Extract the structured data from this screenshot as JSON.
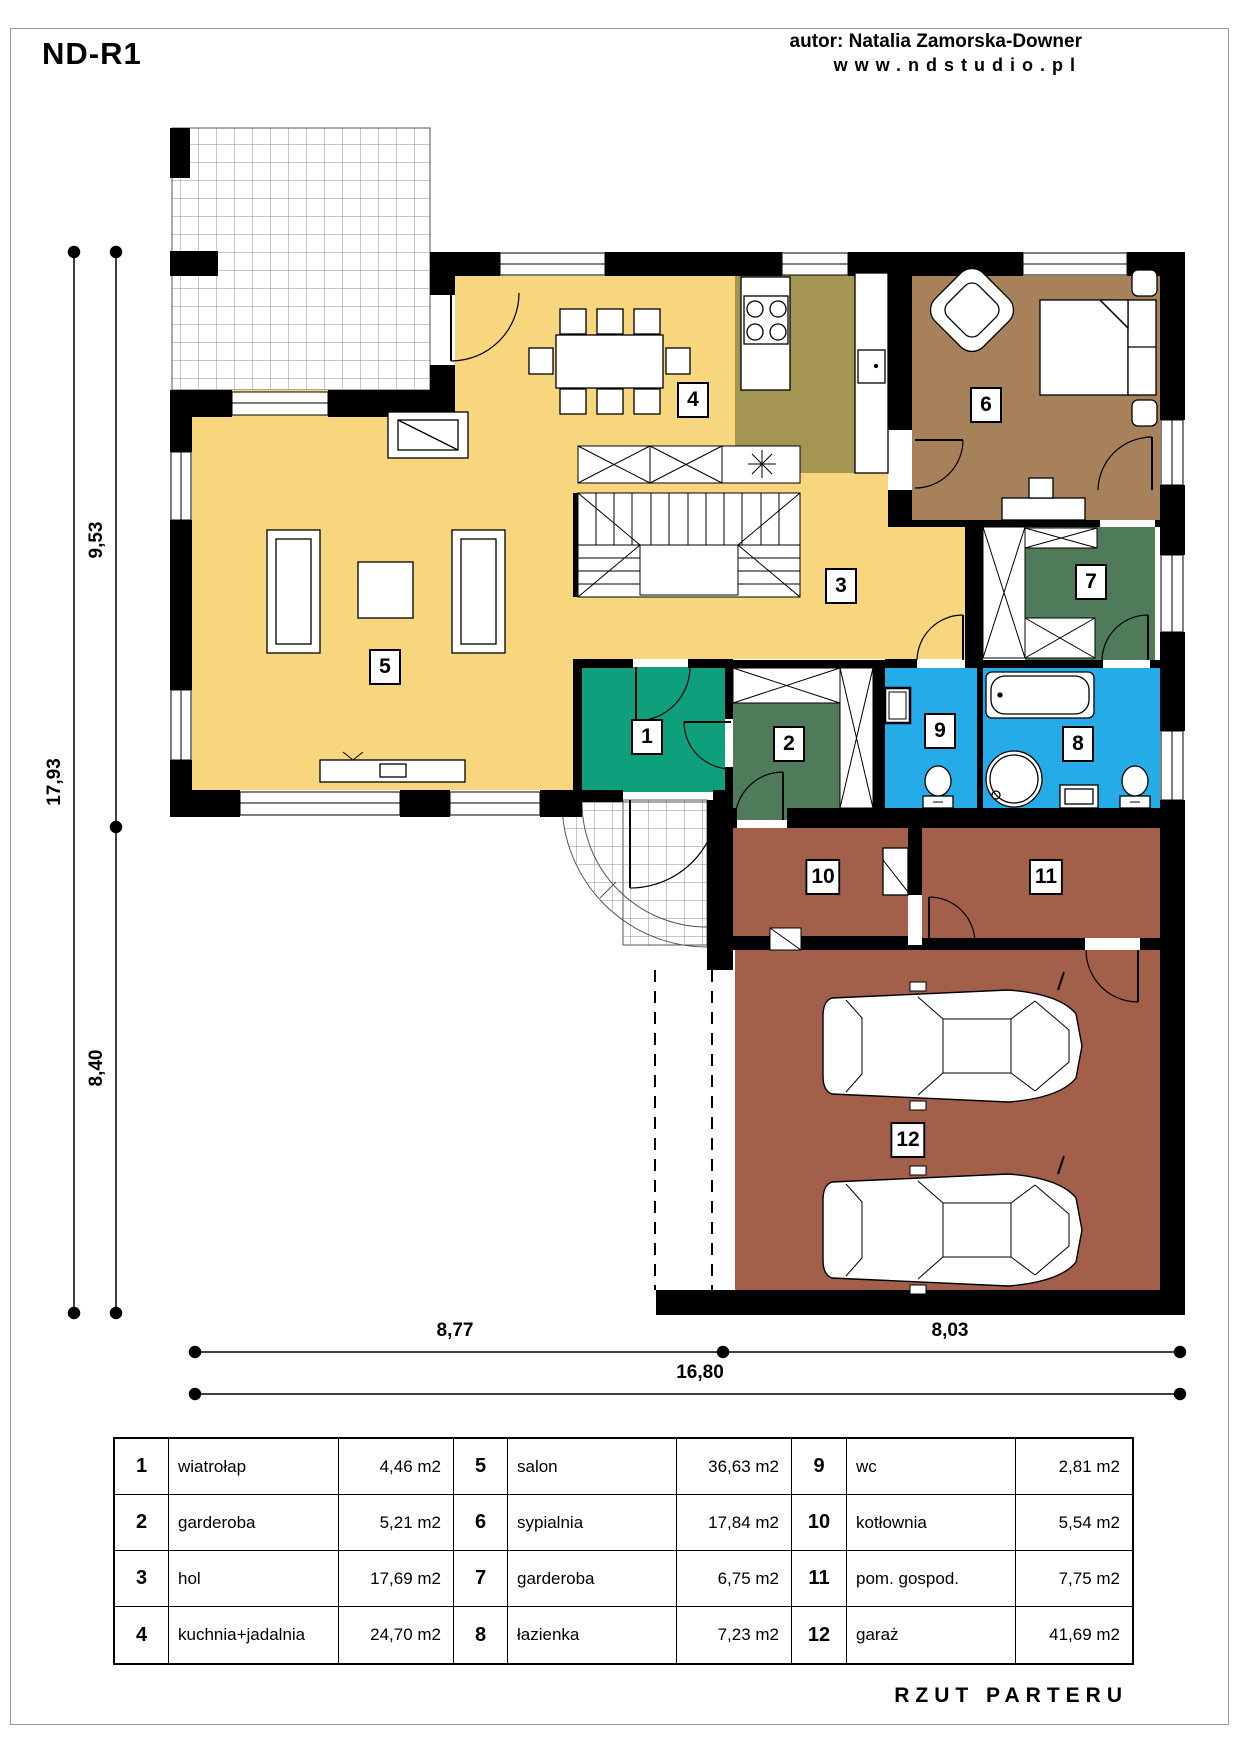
{
  "header": {
    "project_code": "ND-R1",
    "author": "autor: Natalia Zamorska-Downer",
    "website": "www.ndstudio.pl"
  },
  "footer": {
    "drawing_title": "RZUT PARTERU"
  },
  "dimensions": {
    "left_total": "17,93",
    "left_upper": "9,53",
    "left_lower": "8,40",
    "bottom_left": "8,77",
    "bottom_right": "8,03",
    "bottom_total": "16,80"
  },
  "rooms": [
    {
      "num": "1",
      "name": "wiatrołap",
      "area": "4,46 m2",
      "color": "#0EA07C"
    },
    {
      "num": "2",
      "name": "garderoba",
      "area": "5,21 m2",
      "color": "#4F7B5B"
    },
    {
      "num": "3",
      "name": "hol",
      "area": "17,69 m2",
      "color": "#F8D67E"
    },
    {
      "num": "4",
      "name": "kuchnia+jadalnia",
      "area": "24,70 m2",
      "color": "#F8D67E"
    },
    {
      "num": "5",
      "name": "salon",
      "area": "36,63 m2",
      "color": "#F8D67E"
    },
    {
      "num": "6",
      "name": "sypialnia",
      "area": "17,84 m2",
      "color": "#A6815A"
    },
    {
      "num": "7",
      "name": "garderoba",
      "area": "6,75 m2",
      "color": "#4F7B5B"
    },
    {
      "num": "8",
      "name": "łazienka",
      "area": "7,23 m2",
      "color": "#25ABE8"
    },
    {
      "num": "9",
      "name": "wc",
      "area": "2,81 m2",
      "color": "#25ABE8"
    },
    {
      "num": "10",
      "name": "kotłownia",
      "area": "5,54 m2",
      "color": "#A2604B"
    },
    {
      "num": "11",
      "name": "pom. gospod.",
      "area": "7,75 m2",
      "color": "#A2604B"
    },
    {
      "num": "12",
      "name": "garaż",
      "area": "41,69 m2",
      "color": "#A2604B"
    }
  ],
  "palette": {
    "walls": "#000000",
    "day_zone_yellow": "#F8D67E",
    "kitchen_olive": "#A39552",
    "bedroom_brown": "#A6815A",
    "wet_room_cyan": "#25ABE8",
    "wardrobe_green": "#4F7B5B",
    "entry_teal": "#0EA07C",
    "garage_brick": "#A2604B"
  }
}
